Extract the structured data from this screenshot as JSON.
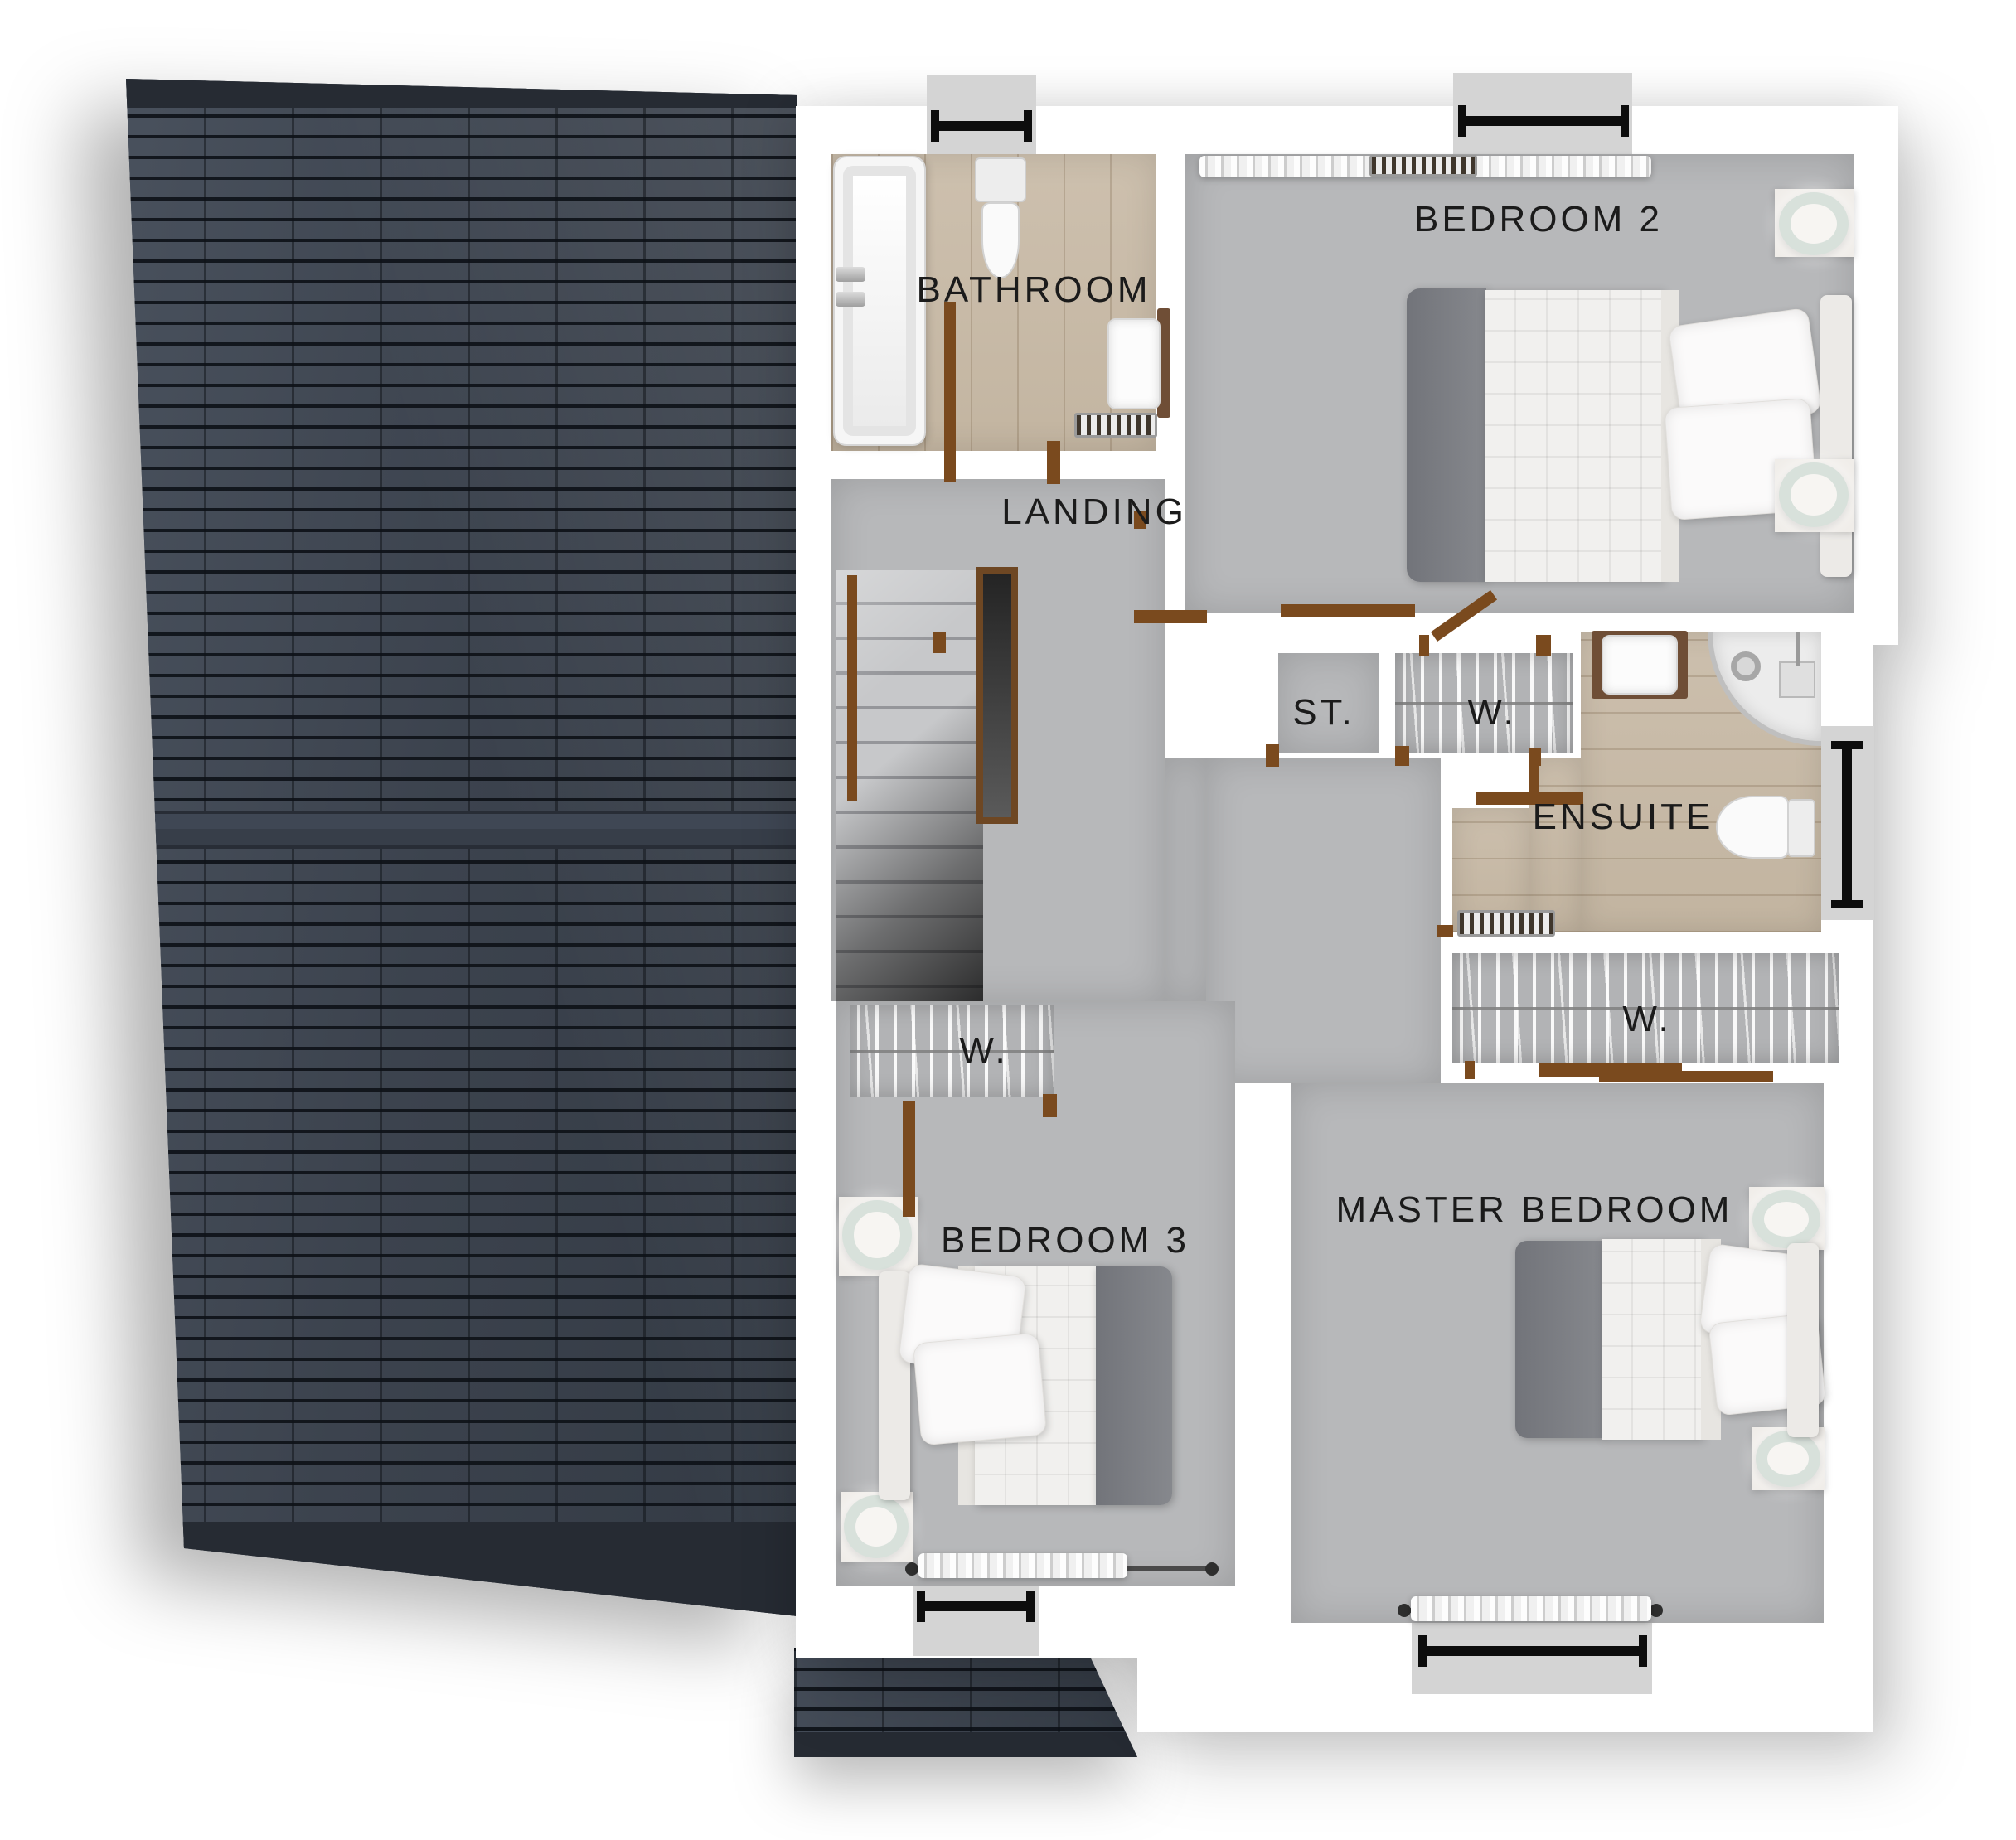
{
  "labels": {
    "bathroom": "BATHROOM",
    "bedroom2": "BEDROOM 2",
    "landing": "LANDING",
    "storage": "ST.",
    "wardrobe": "W.",
    "ensuite": "ENSUITE",
    "bedroom3": "BEDROOM 3",
    "bedroom3_wardrobe": "W.",
    "master_bedroom": "MASTER BEDROOM",
    "master_wardrobe": "W."
  },
  "colors": {
    "roof_tile": "#3d444e",
    "roof_mortar": "#171b21",
    "floor_gray": "#b7b8ba",
    "floor_wood": "#c9bcaa",
    "wall_white": "#ffffff",
    "door_frame_brown": "#7a4a1e",
    "dimension_bar": "#0d0d0d",
    "window_sill": "#d4d4d4",
    "label_text": "#1b1b1b"
  }
}
